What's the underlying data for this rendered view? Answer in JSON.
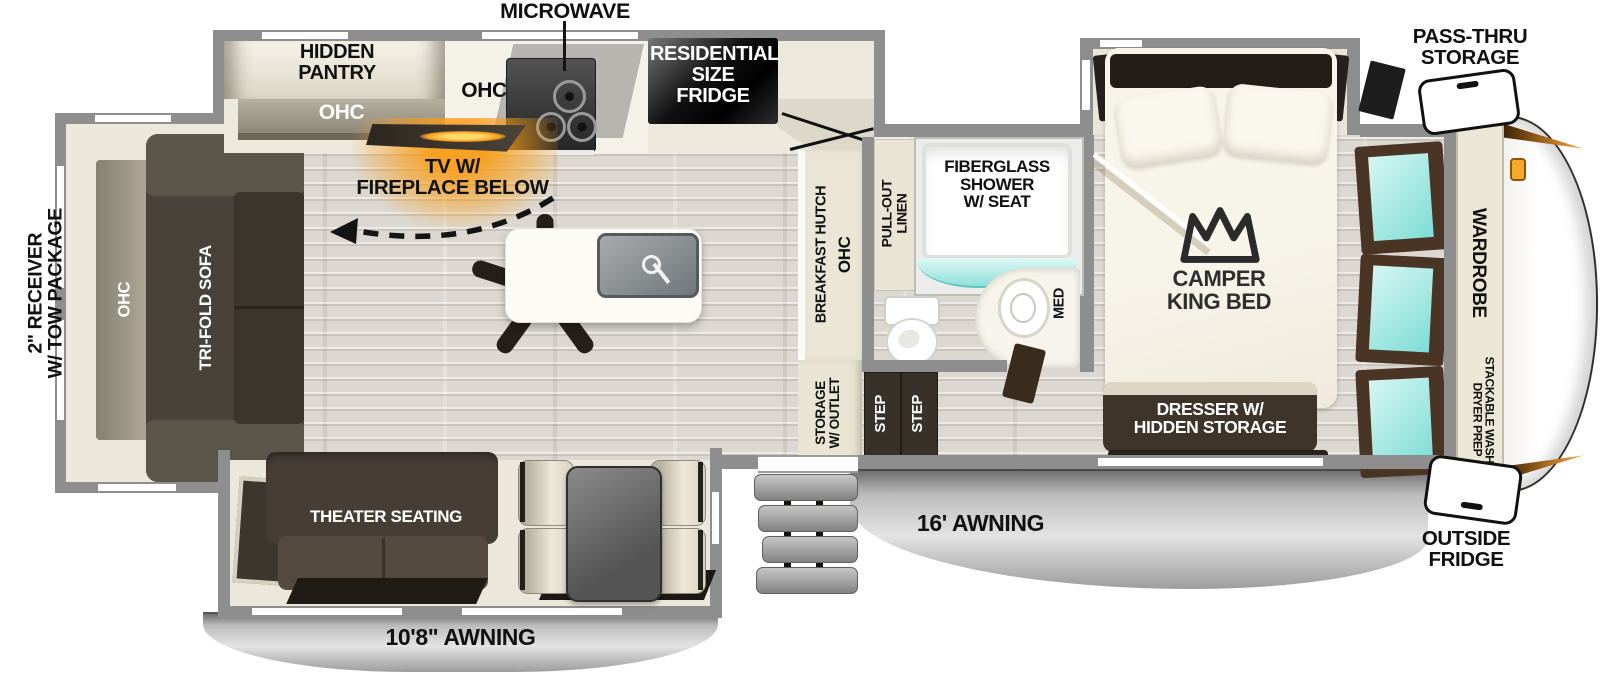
{
  "exterior": {
    "microwave": "MICROWAVE",
    "pass_thru_storage": "PASS-THRU\nSTORAGE",
    "receiver": "2\" RECEIVER\nW/ TOW PACKAGE",
    "outside_fridge": "OUTSIDE\nFRIDGE",
    "awning_main": "16' AWNING",
    "awning_rear": "10'8\" AWNING"
  },
  "kitchen": {
    "hidden_pantry": "HIDDEN\nPANTRY",
    "pantry_ohc": "OHC",
    "kitchen_ohc": "OHC",
    "fridge": "RESIDENTIAL\nSIZE\nFRIDGE",
    "tv_fireplace": "TV W/\nFIREPLACE BELOW"
  },
  "living": {
    "sofa_ohc": "OHC",
    "sofa": "TRI-FOLD SOFA",
    "theater": "THEATER SEATING"
  },
  "bath": {
    "hutch": "BREAKFAST HUTCH",
    "hutch_ohc": "OHC",
    "linen": "PULL-OUT\nLINEN",
    "shower": "FIBERGLASS\nSHOWER\nW/ SEAT",
    "med": "MED",
    "storage_outlet": "STORAGE\nW/ OUTLET",
    "step_upper": "STEP",
    "step_lower": "STEP"
  },
  "bedroom": {
    "bed": "CAMPER\nKING BED",
    "dresser": "DRESSER W/\nHIDDEN STORAGE",
    "wardrobe": "WARDROBE",
    "washer_prep": "STACKABLE WASHER/\nDRYER PREP"
  },
  "colors": {
    "wall": "#8e8e8e",
    "slide_floor": "#ebe7da",
    "dark_furniture": "#453e36",
    "teal_window": "#8fe0da",
    "accent_orange": "#f5a01e",
    "awning_gray": "#c7c7c7"
  }
}
